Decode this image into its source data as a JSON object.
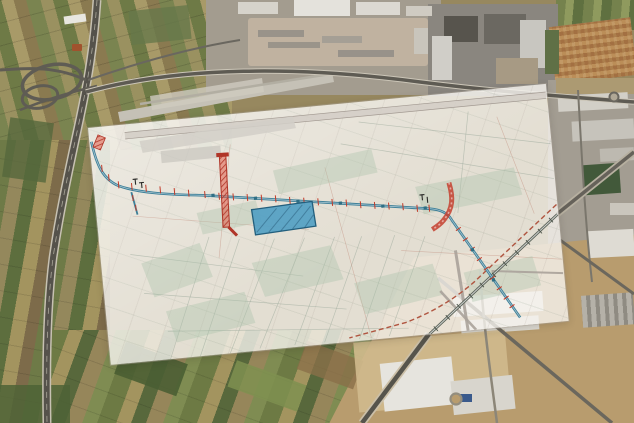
{
  "scene": {
    "kind": "aerial-satellite-view-with-plan-overlay",
    "description": "Satellite photograph of farmland and industrial zones with a semi-transparent engineering plan sheet overlaid at an angle"
  },
  "satellite": {
    "regions": [
      "farmland-northwest",
      "motorway-interchange-west",
      "industrial-estate-north",
      "factory-complex-northeast",
      "urban-blocks-northeast",
      "industrial-strip-east",
      "industrial-estate-southeast",
      "farmland-south",
      "airfield-apron-north"
    ],
    "colors": {
      "field_green": "#6d7a44",
      "field_tan": "#a3945f",
      "highway": "#55524b",
      "building_white": "#e3e1da",
      "ground_tan": "#b89c6e"
    }
  },
  "overlay": {
    "kind": "engineering-plan-sheet",
    "rotation_deg": -5.5,
    "opacity": 0.8,
    "features": {
      "main_route": {
        "name": "pipeline-alignment",
        "color": "#3d7f98"
      },
      "route_casing": {
        "color": "#ffffff"
      },
      "works_zones": {
        "name": "works-hatched-red",
        "color": "#bf3b2a",
        "hatch_fill": "rgba(225,95,75,0.55)"
      },
      "basin": {
        "name": "basin-polygon",
        "color": "#539fc3",
        "border": "#235f7d"
      },
      "railway": {
        "name": "railway-corridor",
        "color": "#5a6258"
      },
      "planned_branch": {
        "name": "dashed-branch-line",
        "color": "#b05540"
      },
      "parcel_lines": {
        "color": "#9aa89a"
      },
      "road_band": {
        "color": "#d2cdc6"
      }
    }
  }
}
